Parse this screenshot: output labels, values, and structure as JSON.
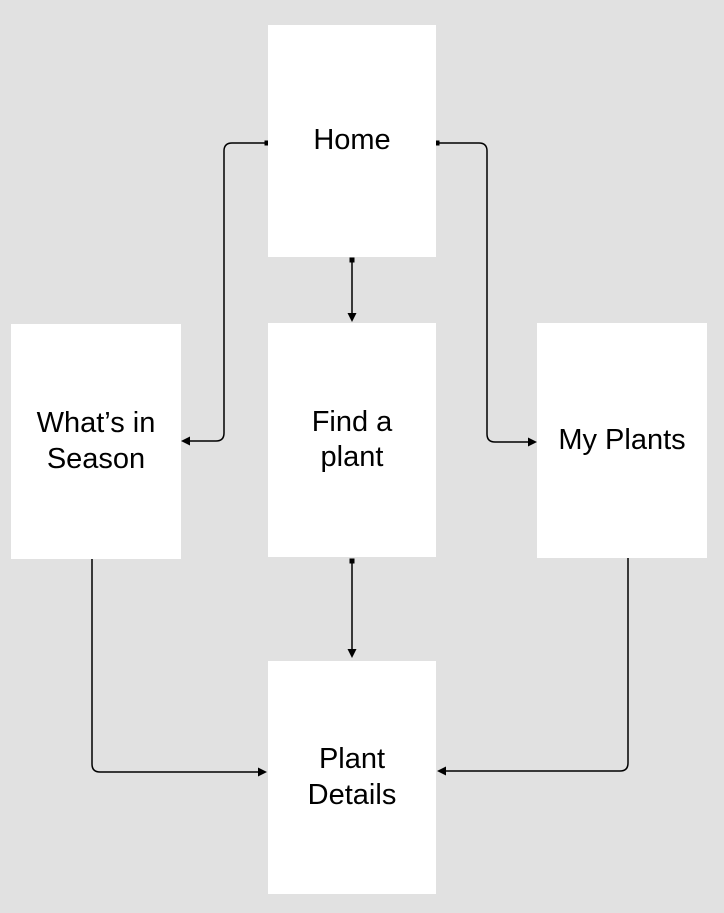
{
  "diagram": {
    "background_color": "#e1e1e1",
    "node_fill_color": "#ffffff",
    "connector_color": "#000000",
    "text_color": "#000000",
    "nodes": {
      "home": {
        "label": "Home"
      },
      "whats_in_season": {
        "label": "What’s in Season"
      },
      "find_a_plant": {
        "label": "Find a plant"
      },
      "my_plants": {
        "label": "My Plants"
      },
      "plant_details": {
        "label": "Plant Details"
      }
    },
    "edges": [
      {
        "from": "Home",
        "to": "What’s in Season"
      },
      {
        "from": "Home",
        "to": "Find a plant"
      },
      {
        "from": "Home",
        "to": "My Plants"
      },
      {
        "from": "What’s in Season",
        "to": "Plant Details"
      },
      {
        "from": "Find a plant",
        "to": "Plant Details"
      },
      {
        "from": "My Plants",
        "to": "Plant Details"
      }
    ]
  }
}
